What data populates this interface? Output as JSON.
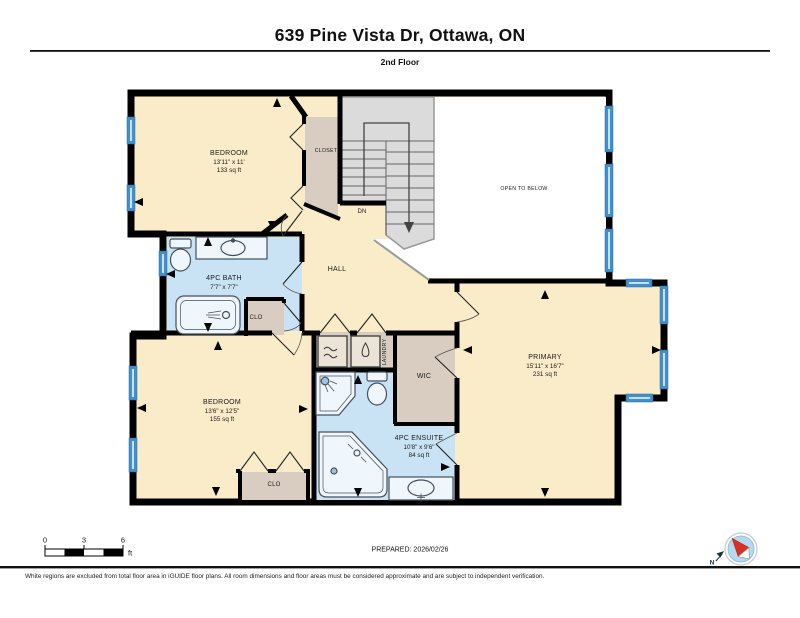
{
  "header": {
    "title": "639 Pine Vista Dr, Ottawa, ON",
    "subtitle": "2nd Floor"
  },
  "rooms": {
    "bedroom_top": {
      "name": "BEDROOM",
      "dimensions": "13'11\" x 11'",
      "area": "133 sq ft"
    },
    "bedroom_bottom": {
      "name": "BEDROOM",
      "dimensions": "13'6\" x 12'5\"",
      "area": "155 sq ft"
    },
    "primary": {
      "name": "PRIMARY",
      "dimensions": "15'11\" x 16'7\"",
      "area": "231 sq ft"
    },
    "bath": {
      "name": "4PC BATH",
      "dimensions": "7'7\" x 7'7\""
    },
    "ensuite": {
      "name": "4PC ENSUITE",
      "dimensions": "10'8\" x 9'6\"",
      "area": "84 sq ft"
    },
    "hall": {
      "name": "HALL"
    },
    "closet": {
      "name": "CLOSET"
    },
    "clo_bath": {
      "name": "CLO"
    },
    "clo_bedroom": {
      "name": "CLO"
    },
    "wic": {
      "name": "WIC"
    },
    "laundry": {
      "name": "LAUNDRY"
    },
    "open_to_below": {
      "name": "OPEN TO BELOW"
    },
    "stairs": {
      "direction_label": "DN"
    }
  },
  "scale_bar": {
    "labels": [
      "0",
      "3",
      "6"
    ],
    "unit": "ft"
  },
  "compass": {
    "north_label": "N"
  },
  "footer": {
    "prepared": "PREPARED: 2026/02/26",
    "disclaimer": "White regions are excluded from total floor area in iGUIDE floor plans. All room dimensions and floor areas must be considered approximate and are subject to independent verification."
  },
  "colors": {
    "room_fill": "#FAECC8",
    "bath_fill": "#C9E3F4",
    "closet_fill": "#D8CDC0",
    "stairs_fill": "#DBDBDB",
    "window_blue": "#418FCC",
    "wall": "#000000",
    "compass_needle_red": "#D93025"
  }
}
